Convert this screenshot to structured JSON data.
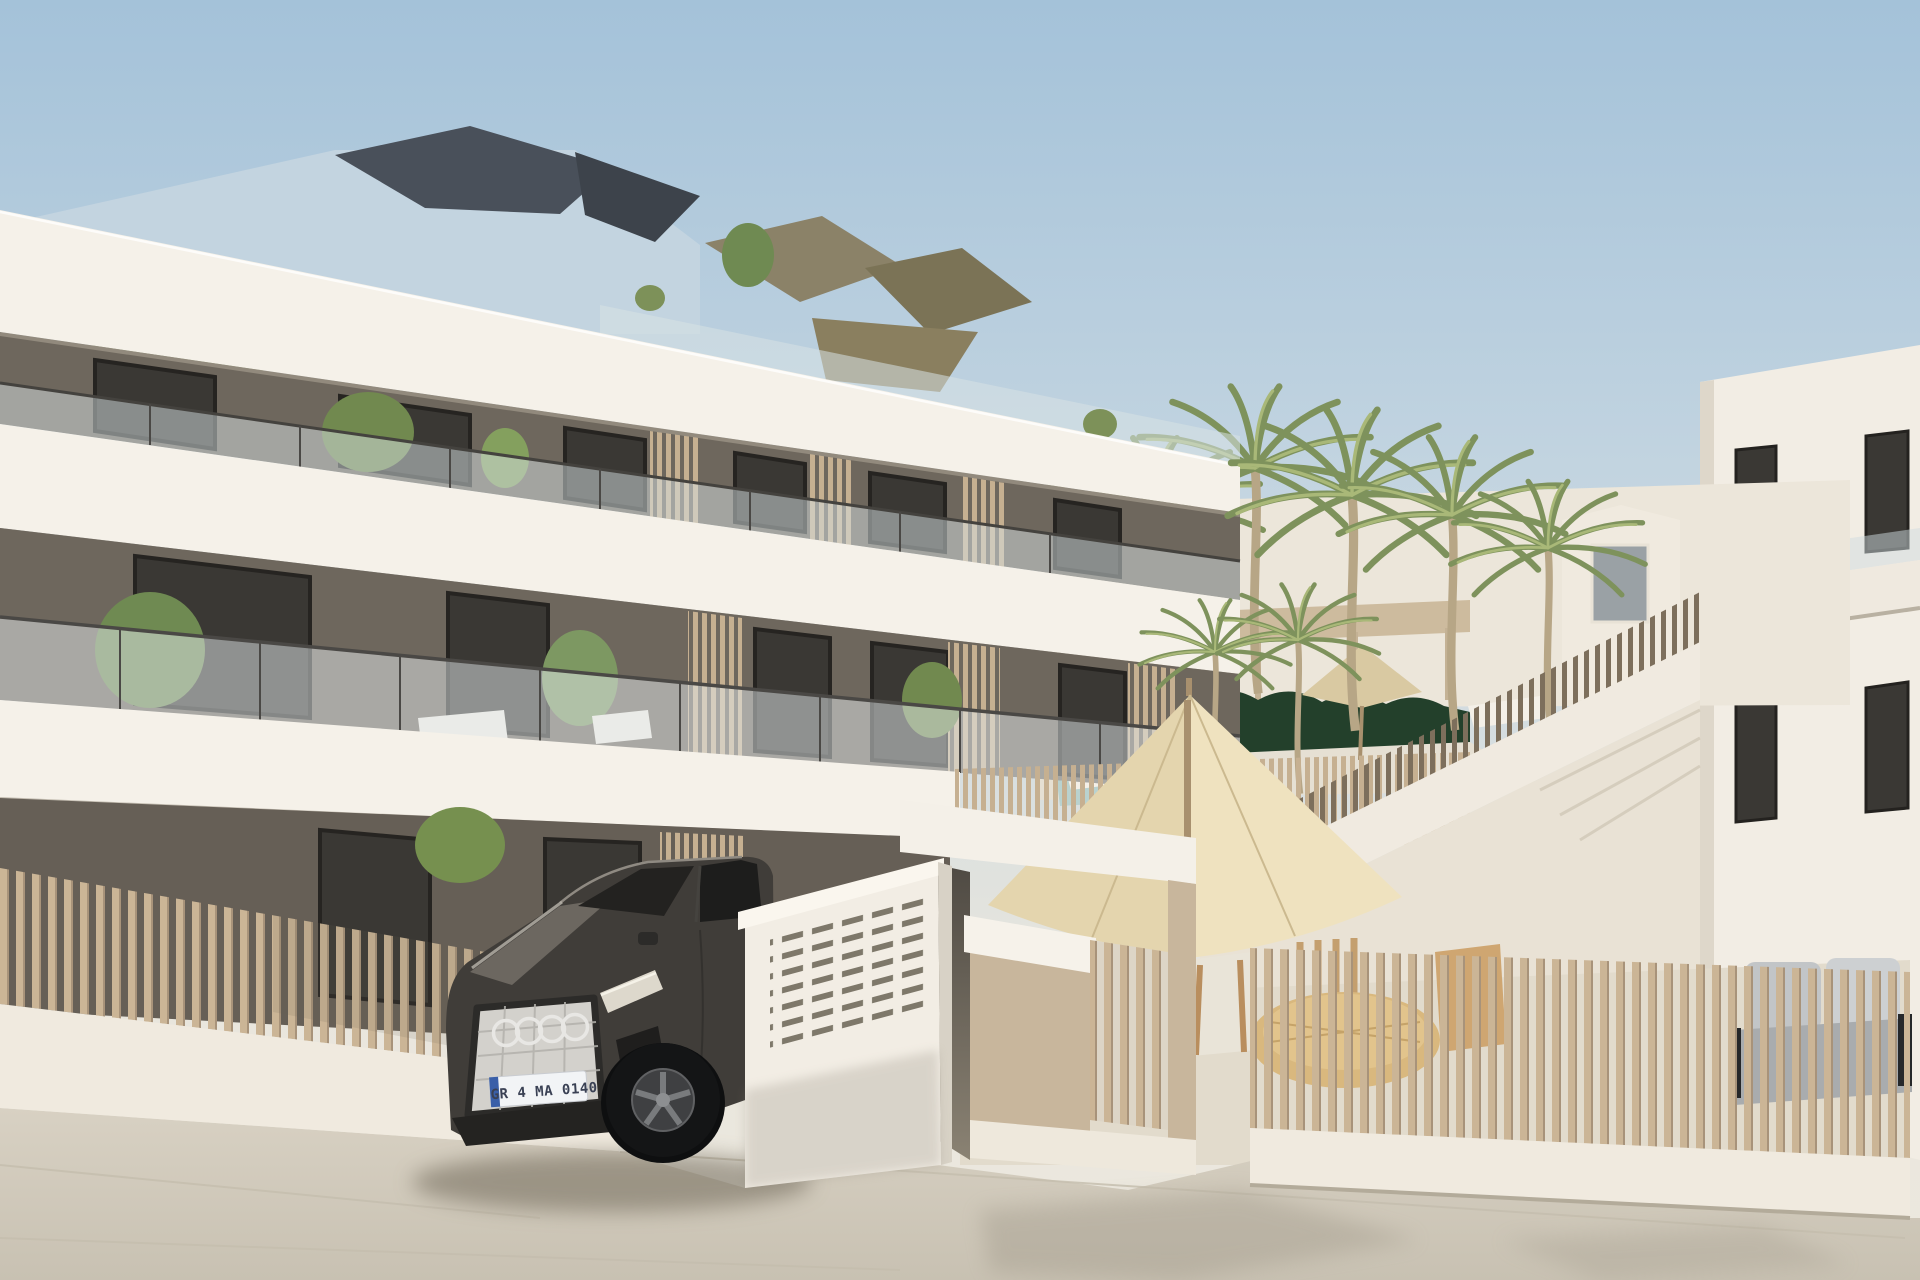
{
  "meta": {
    "type": "architectural-render",
    "description": "New-build modern apartment complex with white balcony bands, taupe recessed walls, slatted tan fences, pool courtyard with palm trees, cream parasols and a dark SUV parked at the entrance"
  },
  "palette": {
    "sky_top": "#a4c2d9",
    "sky_mid": "#c9d8e2",
    "sky_horizon": "#e9e6dd",
    "facade_white": "#f5f1e9",
    "facade_shadow": "#e7e0d4",
    "dark_wall": "#6e675d",
    "ground_wall": "#665f56",
    "window_glass": "#3a3834",
    "window_frame": "#24221f",
    "fence_slat": "#cbb596",
    "fence_slat_fine": "#c6b091",
    "stair_slat": "#7d6f5c",
    "base_wall": "#f0eadf",
    "pavement": "#d8d1c3",
    "pavement_low": "#c8c1b2",
    "hedge": "#23402b",
    "palm_green": "#7e925c",
    "palm_trunk": "#b7a686",
    "umbrella_light": "#efe2bf",
    "umbrella_shade": "#e4d5ae",
    "parasol_olive": "#8a7f5f",
    "right_building": "#f2ede4",
    "courtyard_wall": "#ece6da",
    "car_body": "#403d39",
    "car_glass": "#232220",
    "grille_silver": "#d3d1cc",
    "wicker": "#d9b87e",
    "sofa_gray": "#c2c5c7",
    "glass_tint": "#d7e1e4",
    "pillar_beige": "#c8b69c",
    "roof_slate": "#49505a",
    "roof_olive": "#8b8268",
    "pool_water": "#b9d2cf"
  },
  "car": {
    "plate": "GR 4 MA 0140",
    "brand": "audi-rings"
  },
  "scene": {
    "objects": [
      "apartment-building",
      "balconies",
      "glass-balustrades",
      "palm-trees",
      "pool-courtyard",
      "slatted-fences",
      "entrance-gate",
      "mailbox-panel",
      "parked-suv",
      "parasols",
      "outdoor-dining-set",
      "outdoor-sofa",
      "staircase",
      "pavement"
    ]
  }
}
